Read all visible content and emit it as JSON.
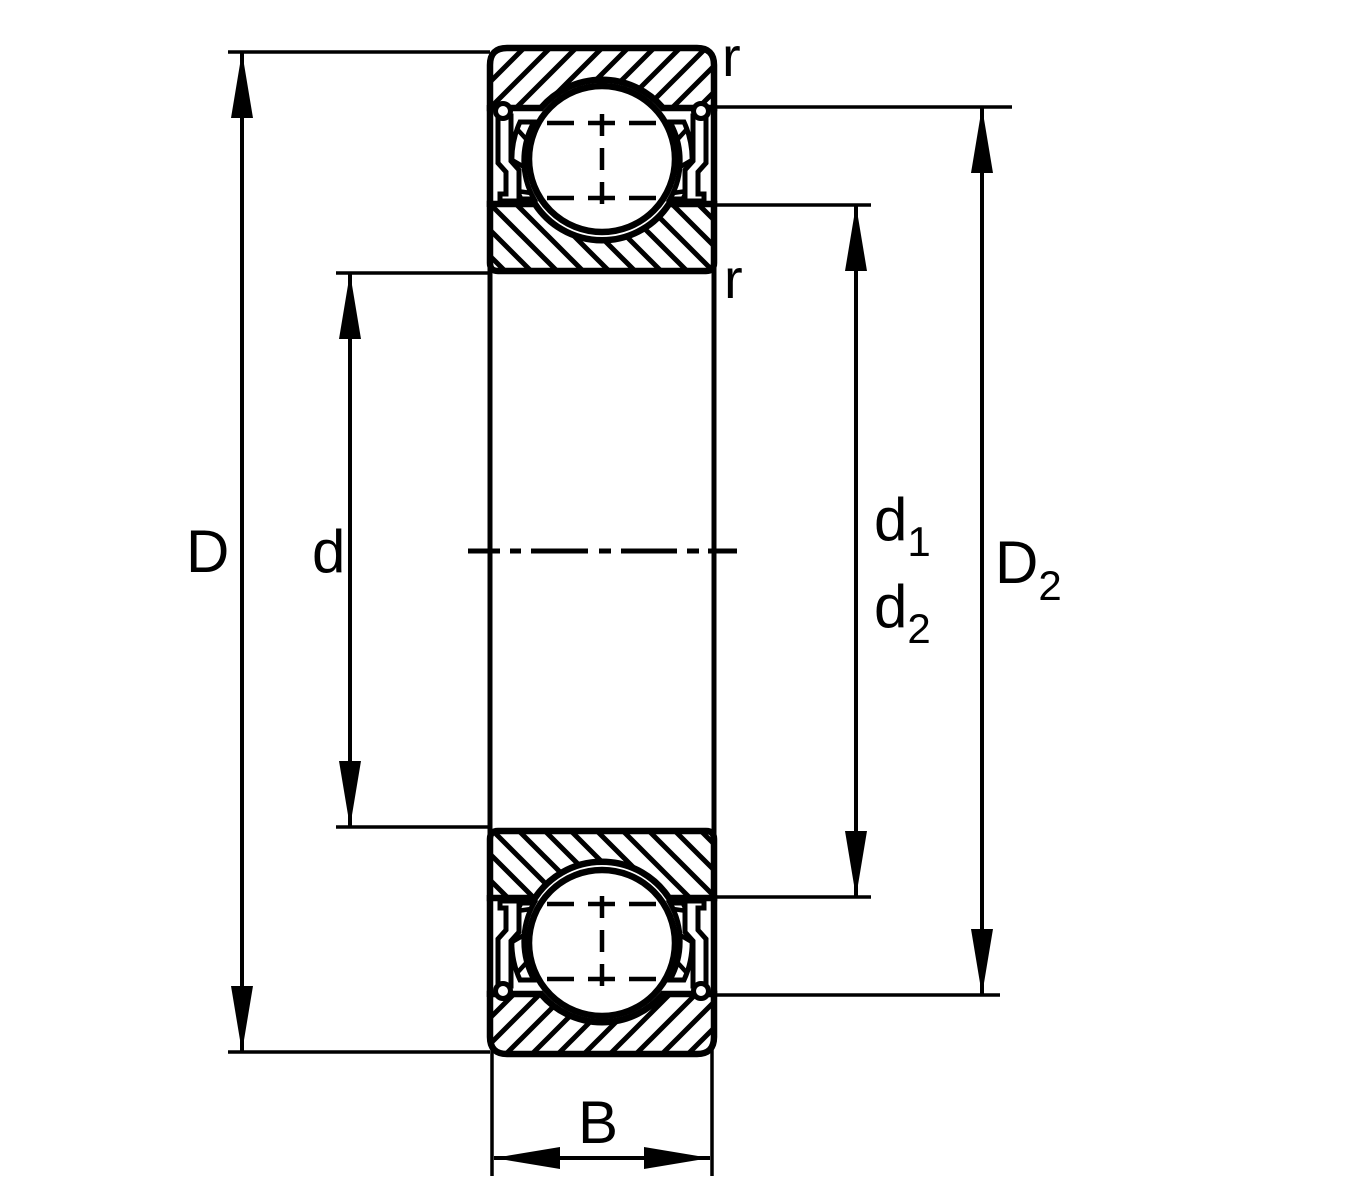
{
  "figure": {
    "kind": "bearing cross-section dimension drawing",
    "background_color": "#ffffff",
    "line_color": "#000000"
  },
  "labels": {
    "outer_diameter": "D",
    "bore_diameter": "d",
    "d1_base": "d",
    "d1_sub": "1",
    "d2_base": "d",
    "d2_sub": "2",
    "D2_base": "D",
    "D2_sub": "2",
    "width": "B",
    "radius_outer": "r",
    "radius_inner": "r"
  }
}
